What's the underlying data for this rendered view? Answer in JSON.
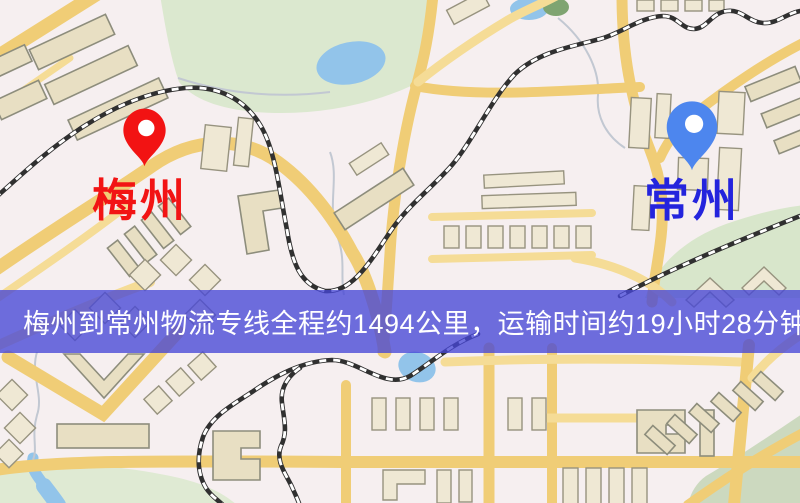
{
  "map": {
    "origin": {
      "name": "梅州",
      "pin_icon": "location-pin-icon",
      "pin_color": "#f21313",
      "label_color": "#f21414"
    },
    "destination": {
      "name": "常州",
      "pin_icon": "location-pin-icon",
      "pin_color": "#4d86ee",
      "label_color": "#2424dd"
    },
    "palette": {
      "background": "#f6eff0",
      "road": "#f0cd76",
      "building": "#e8dfc3",
      "park": "#dbe8cf",
      "water": "#92c4ea",
      "railway": "#303030"
    }
  },
  "banner": {
    "text": "梅州到常州物流专线全程约1494公里，运输时间约19小时28分钟.",
    "background_color": "#4646d6",
    "text_color": "#ffffff"
  },
  "route": {
    "origin": "梅州",
    "destination": "常州",
    "distance_km": "1494",
    "duration": "19小时28分钟"
  }
}
